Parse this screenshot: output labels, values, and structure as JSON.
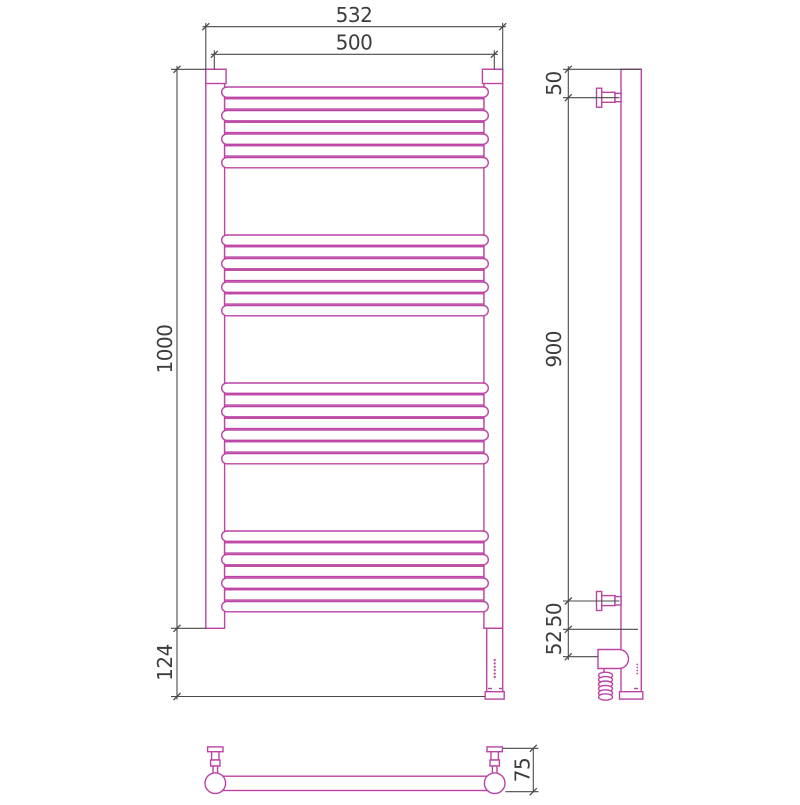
{
  "colors": {
    "outline": "#bb44a4",
    "dimension": "#4a4a4a",
    "text": "#3d3d3d",
    "background": "#ffffff"
  },
  "front_view": {
    "width_overall": "532",
    "rung_width": "500",
    "height": "1000",
    "heater_drop": "124"
  },
  "side_view": {
    "top_bracket_offset": "50",
    "bracket_span": "900",
    "bottom_bracket_offset": "50",
    "heater_axis_offset": "52"
  },
  "top_view": {
    "depth": "75"
  }
}
